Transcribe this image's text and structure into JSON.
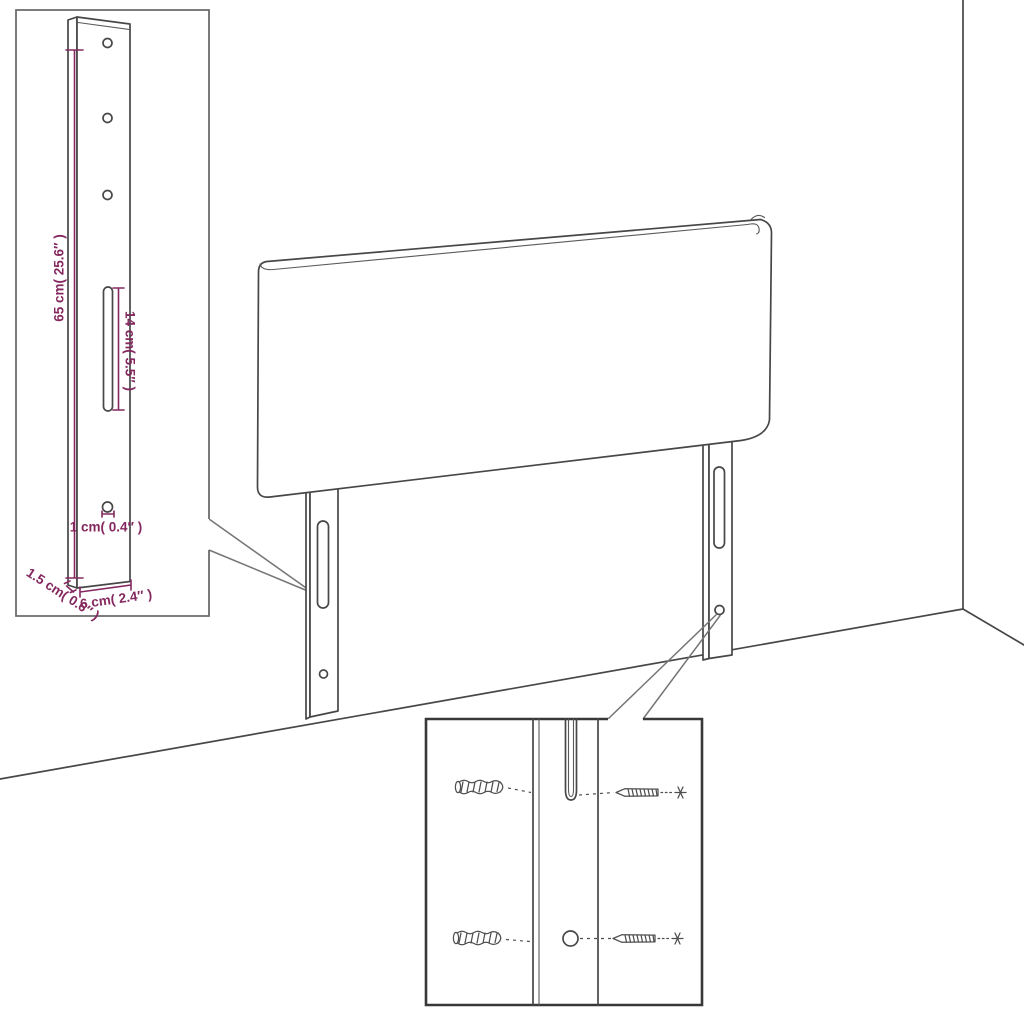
{
  "diagram": {
    "kind": "headboard mounting and dimensions line drawing",
    "labels": {
      "leg_height": "65 cm( 25.6″ )",
      "slot_length": "14 cm( 5.5″ )",
      "hole_diameter": "1 cm( 0.4″ )",
      "leg_thickness": "1.5 cm( 0.6″ )",
      "leg_width": "6 cm( 2.4″ )"
    },
    "colors": {
      "dimension_text": "#84285F",
      "drawing_line": "#474747",
      "background": "#FFFFFF"
    },
    "icons": {
      "wall_plug": "ribbed-wall-plug-sketch",
      "screw": "pointed-screw-sketch"
    }
  }
}
